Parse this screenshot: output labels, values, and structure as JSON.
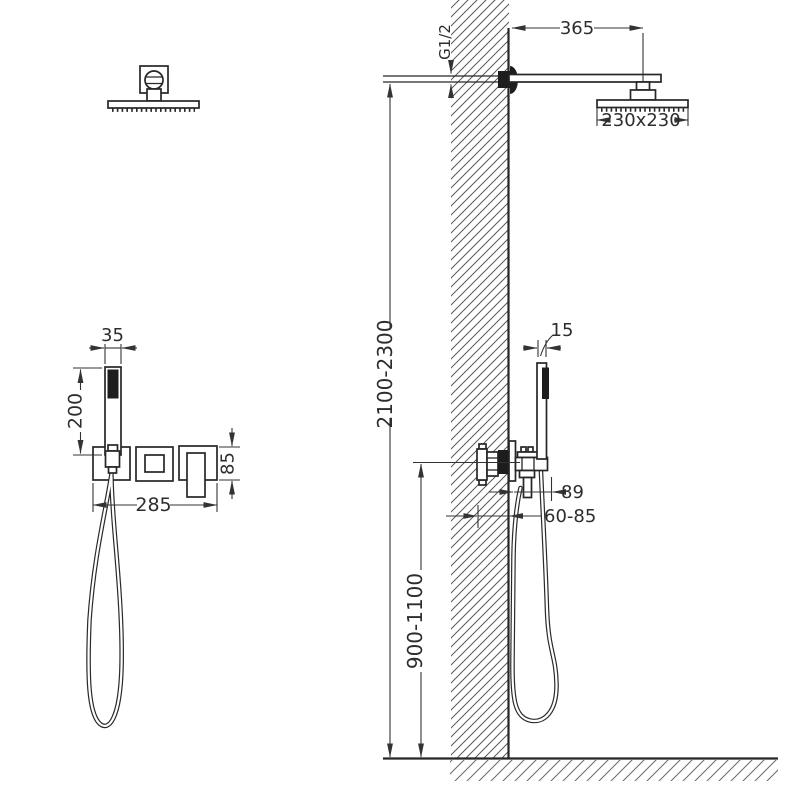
{
  "drawing": {
    "colors": {
      "line": "#262626",
      "dimension_line": "#333333",
      "hatch": "#595959",
      "background": "#ffffff"
    },
    "dimensions": {
      "arm_length": "365",
      "head_size": "230x230",
      "thread": "G1/2",
      "install_height": "2100-2300",
      "valve_height": "900-1100",
      "handshower_width": "35",
      "handshower_length": "200",
      "trim_width": "285",
      "plate_height": "85",
      "handshower_depth": "15",
      "projection": "89",
      "embed_depth": "60-85"
    }
  }
}
